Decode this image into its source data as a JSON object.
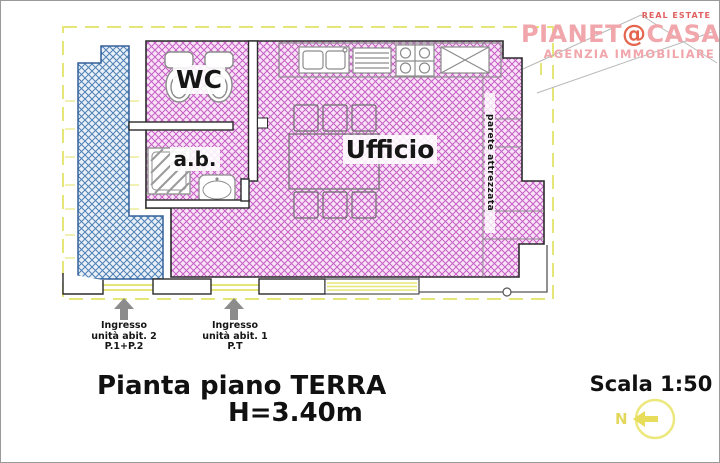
{
  "logo": {
    "real_estate": "REAL ESTATE",
    "brand_pre": "PIANET",
    "brand_at": "@",
    "brand_post": "CASA",
    "agency": "AGENZIA IMMOBILIARE"
  },
  "rooms": {
    "wc": "WC",
    "ab": "a.b.",
    "office": "Ufficio",
    "equipped_wall": "parete attrezzata"
  },
  "entrances": {
    "unit2": {
      "l1": "Ingresso",
      "l2": "unità abit. 2",
      "l3": "P.1+P.2"
    },
    "unit1": {
      "l1": "Ingresso",
      "l2": "unità abit. 1",
      "l3": "P.T"
    }
  },
  "captions": {
    "title": "Pianta piano TERRA",
    "height": "H=3.40m",
    "scale": "Scala 1:50",
    "north": "N"
  },
  "colors": {
    "magenta_hatch": "#c65ec6",
    "magenta_bg": "#f9e4f7",
    "blue_hatch": "#4d7fb5",
    "blue_bg": "#e9f0f7",
    "boundary_yellow": "#e5e578",
    "wall_black": "#2b2b2b",
    "fixture_gray": "#8c8c8c",
    "logo_pink": "#f0a6aa",
    "logo_orange": "#e4654e"
  }
}
